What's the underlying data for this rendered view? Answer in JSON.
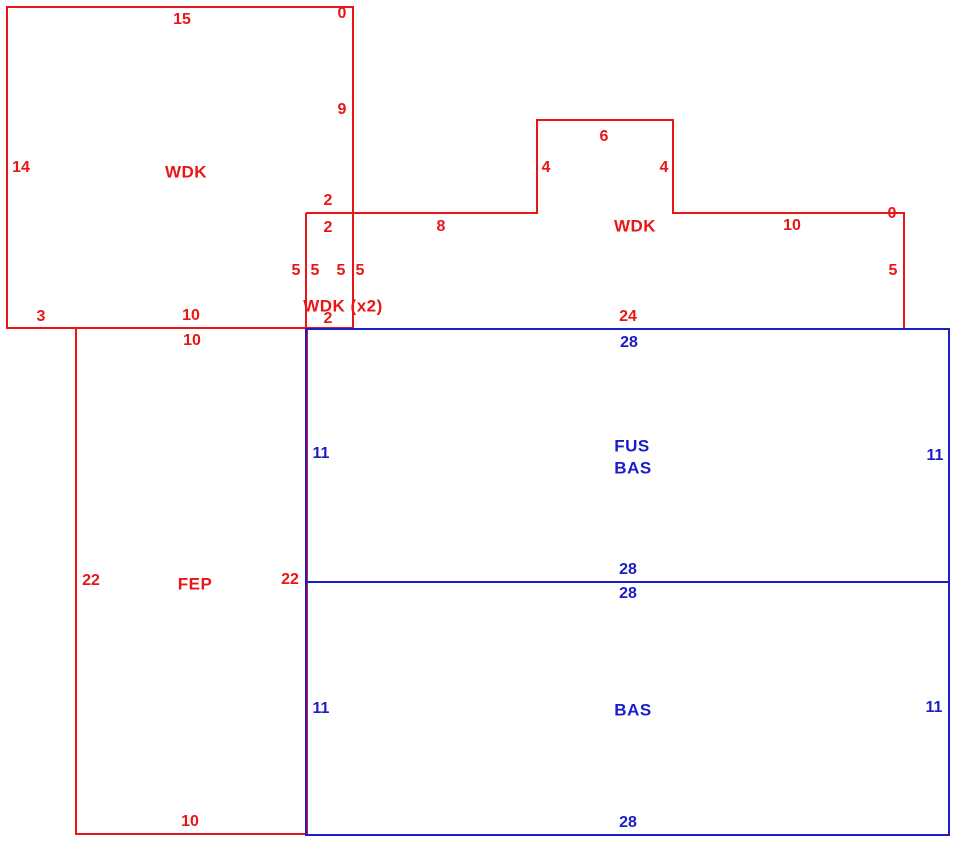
{
  "canvas": {
    "width": 970,
    "height": 867,
    "background": "#ffffff"
  },
  "colors": {
    "red": "#e81616",
    "blue": "#1c1cc8"
  },
  "sketch": {
    "description": "Property floor sketch with deck (WDK), enclosed porch (FEP), finished upper story over basement (FUS/BAS) and basement (BAS) areas",
    "shapes": [
      {
        "name": "wdk-topleft-outline",
        "color": "red",
        "closed": true,
        "points": [
          [
            7,
            7
          ],
          [
            353,
            7
          ],
          [
            353,
            328
          ],
          [
            7,
            328
          ]
        ]
      },
      {
        "name": "wdk-right-outline",
        "color": "red",
        "closed": false,
        "points": [
          [
            306,
            213
          ],
          [
            537,
            213
          ],
          [
            537,
            120
          ],
          [
            673,
            120
          ],
          [
            673,
            213
          ],
          [
            904,
            213
          ],
          [
            904,
            328
          ]
        ]
      },
      {
        "name": "wdk-x2-left-edge",
        "color": "red",
        "closed": false,
        "points": [
          [
            306,
            213
          ],
          [
            306,
            328
          ]
        ]
      },
      {
        "name": "fep-outline",
        "color": "red",
        "closed": true,
        "points": [
          [
            76,
            328
          ],
          [
            307,
            328
          ],
          [
            307,
            834
          ],
          [
            76,
            834
          ]
        ]
      },
      {
        "name": "bas-outer-outline",
        "color": "blue",
        "closed": true,
        "points": [
          [
            306,
            329
          ],
          [
            949,
            329
          ],
          [
            949,
            835
          ],
          [
            306,
            835
          ]
        ]
      },
      {
        "name": "bas-floor-divider",
        "color": "blue",
        "closed": false,
        "points": [
          [
            306,
            582
          ],
          [
            949,
            582
          ]
        ]
      }
    ],
    "labels": [
      {
        "name": "wdk1-dim-top-15",
        "text": "15",
        "x": 182,
        "y": 20,
        "color": "red",
        "kind": "dim"
      },
      {
        "name": "wdk1-dim-topright-0",
        "text": "0",
        "x": 342,
        "y": 14,
        "color": "red",
        "kind": "dim"
      },
      {
        "name": "wdk1-dim-right-9",
        "text": "9",
        "x": 342,
        "y": 110,
        "color": "red",
        "kind": "dim"
      },
      {
        "name": "wdk1-dim-left-14",
        "text": "14",
        "x": 21,
        "y": 168,
        "color": "red",
        "kind": "dim"
      },
      {
        "name": "wdk1-area-label",
        "text": "WDK",
        "x": 186,
        "y": 172,
        "color": "red",
        "kind": "area"
      },
      {
        "name": "wdk2-dim-2-above",
        "text": "2",
        "x": 328,
        "y": 201,
        "color": "red",
        "kind": "dim"
      },
      {
        "name": "wdk2-dim-2-below",
        "text": "2",
        "x": 328,
        "y": 228,
        "color": "red",
        "kind": "dim"
      },
      {
        "name": "wdk2-dim-top-8",
        "text": "8",
        "x": 441,
        "y": 227,
        "color": "red",
        "kind": "dim"
      },
      {
        "name": "wdk2-dim-notch-top-6",
        "text": "6",
        "x": 604,
        "y": 137,
        "color": "red",
        "kind": "dim"
      },
      {
        "name": "wdk2-dim-notch-left-4",
        "text": "4",
        "x": 546,
        "y": 168,
        "color": "red",
        "kind": "dim"
      },
      {
        "name": "wdk2-dim-notch-right-4",
        "text": "4",
        "x": 664,
        "y": 168,
        "color": "red",
        "kind": "dim"
      },
      {
        "name": "wdk2-area-label",
        "text": "WDK",
        "x": 635,
        "y": 226,
        "color": "red",
        "kind": "area"
      },
      {
        "name": "wdk2-dim-top-10",
        "text": "10",
        "x": 792,
        "y": 226,
        "color": "red",
        "kind": "dim"
      },
      {
        "name": "wdk2-dim-topright-0",
        "text": "0",
        "x": 892,
        "y": 214,
        "color": "red",
        "kind": "dim"
      },
      {
        "name": "wdk2-dim-right-5",
        "text": "5",
        "x": 893,
        "y": 271,
        "color": "red",
        "kind": "dim"
      },
      {
        "name": "wdk2-dim-bottom-24",
        "text": "24",
        "x": 628,
        "y": 317,
        "color": "red",
        "kind": "dim"
      },
      {
        "name": "wdkx2-dim-5-a",
        "text": "5",
        "x": 296,
        "y": 271,
        "color": "red",
        "kind": "dim"
      },
      {
        "name": "wdkx2-dim-5-b",
        "text": "5",
        "x": 315,
        "y": 271,
        "color": "red",
        "kind": "dim"
      },
      {
        "name": "wdkx2-dim-5-c",
        "text": "5",
        "x": 341,
        "y": 271,
        "color": "red",
        "kind": "dim"
      },
      {
        "name": "wdkx2-dim-5-d",
        "text": "5",
        "x": 360,
        "y": 271,
        "color": "red",
        "kind": "dim"
      },
      {
        "name": "wdkx2-area-label",
        "text": "WDK (x2)",
        "x": 343,
        "y": 306,
        "color": "red",
        "kind": "area"
      },
      {
        "name": "wdkx2-dim-bottom-2",
        "text": "2",
        "x": 328,
        "y": 319,
        "color": "red",
        "kind": "dim"
      },
      {
        "name": "wdk1-dim-bottom-3",
        "text": "3",
        "x": 41,
        "y": 317,
        "color": "red",
        "kind": "dim"
      },
      {
        "name": "wdk1-dim-bottom-10",
        "text": "10",
        "x": 191,
        "y": 316,
        "color": "red",
        "kind": "dim"
      },
      {
        "name": "fep-dim-top-10",
        "text": "10",
        "x": 192,
        "y": 341,
        "color": "red",
        "kind": "dim"
      },
      {
        "name": "fep-dim-left-22",
        "text": "22",
        "x": 91,
        "y": 581,
        "color": "red",
        "kind": "dim"
      },
      {
        "name": "fep-area-label",
        "text": "FEP",
        "x": 195,
        "y": 584,
        "color": "red",
        "kind": "area"
      },
      {
        "name": "fep-dim-right-22",
        "text": "22",
        "x": 290,
        "y": 580,
        "color": "red",
        "kind": "dim"
      },
      {
        "name": "fep-dim-bottom-10",
        "text": "10",
        "x": 190,
        "y": 822,
        "color": "red",
        "kind": "dim"
      },
      {
        "name": "fus-dim-top-28",
        "text": "28",
        "x": 629,
        "y": 343,
        "color": "blue",
        "kind": "dim"
      },
      {
        "name": "fus-dim-left-11",
        "text": "11",
        "x": 321,
        "y": 454,
        "color": "blue",
        "kind": "dim"
      },
      {
        "name": "fus-area-label-line1",
        "text": "FUS",
        "x": 632,
        "y": 446,
        "color": "blue",
        "kind": "area"
      },
      {
        "name": "fus-area-label-line2",
        "text": "BAS",
        "x": 633,
        "y": 468,
        "color": "blue",
        "kind": "area"
      },
      {
        "name": "fus-dim-right-11",
        "text": "11",
        "x": 935,
        "y": 456,
        "color": "blue",
        "kind": "dim"
      },
      {
        "name": "fus-dim-bottom-28",
        "text": "28",
        "x": 628,
        "y": 570,
        "color": "blue",
        "kind": "dim"
      },
      {
        "name": "bas-dim-top-28",
        "text": "28",
        "x": 628,
        "y": 594,
        "color": "blue",
        "kind": "dim"
      },
      {
        "name": "bas-dim-left-11",
        "text": "11",
        "x": 321,
        "y": 709,
        "color": "blue",
        "kind": "dim"
      },
      {
        "name": "bas-area-label",
        "text": "BAS",
        "x": 633,
        "y": 710,
        "color": "blue",
        "kind": "area"
      },
      {
        "name": "bas-dim-right-11",
        "text": "11",
        "x": 934,
        "y": 708,
        "color": "blue",
        "kind": "dim"
      },
      {
        "name": "bas-dim-bottom-28",
        "text": "28",
        "x": 628,
        "y": 823,
        "color": "blue",
        "kind": "dim"
      }
    ]
  }
}
